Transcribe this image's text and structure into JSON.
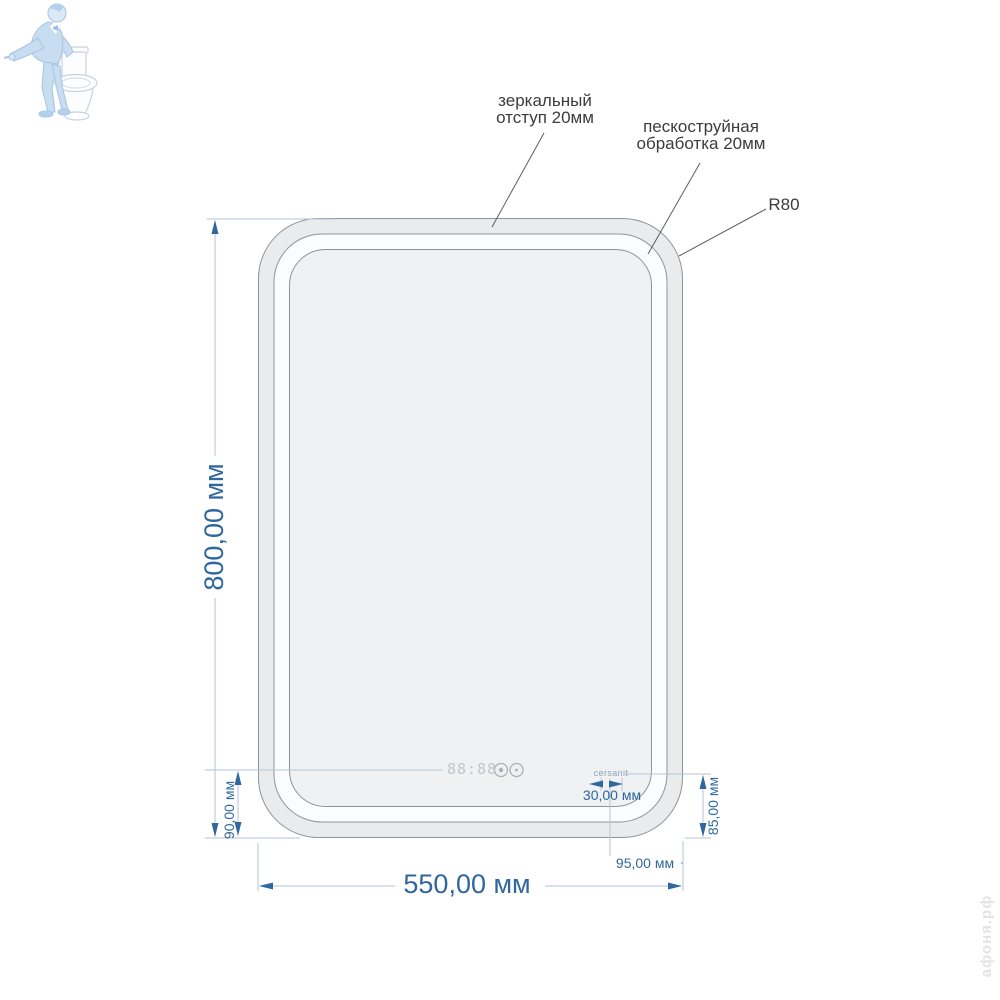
{
  "annotations": {
    "mirror_offset": "зеркальный\nотступ 20мм",
    "sandblast": "пескоструйная\nобработка 20мм",
    "radius": "R80"
  },
  "dimensions": {
    "height": "800,00 мм",
    "width": "550,00 мм",
    "clock_to_bottom": "90,00 мм",
    "logo_to_bottom": "85,00 мм",
    "logo_to_right": "95,00 мм",
    "logo_width": "30,00 мм"
  },
  "mirror": {
    "brand_logo": "cersanit",
    "clock_display": "88:88"
  },
  "watermark": {
    "site": "афоня.рф",
    "figure": "plumber-with-toilet"
  },
  "colors": {
    "dimension_blue": "#2f679e",
    "construction_line": "#b3c6d9",
    "outline_gray": "#909496",
    "annotation_text": "#3c3c3c",
    "watermark_blue": "#adc8e4"
  }
}
